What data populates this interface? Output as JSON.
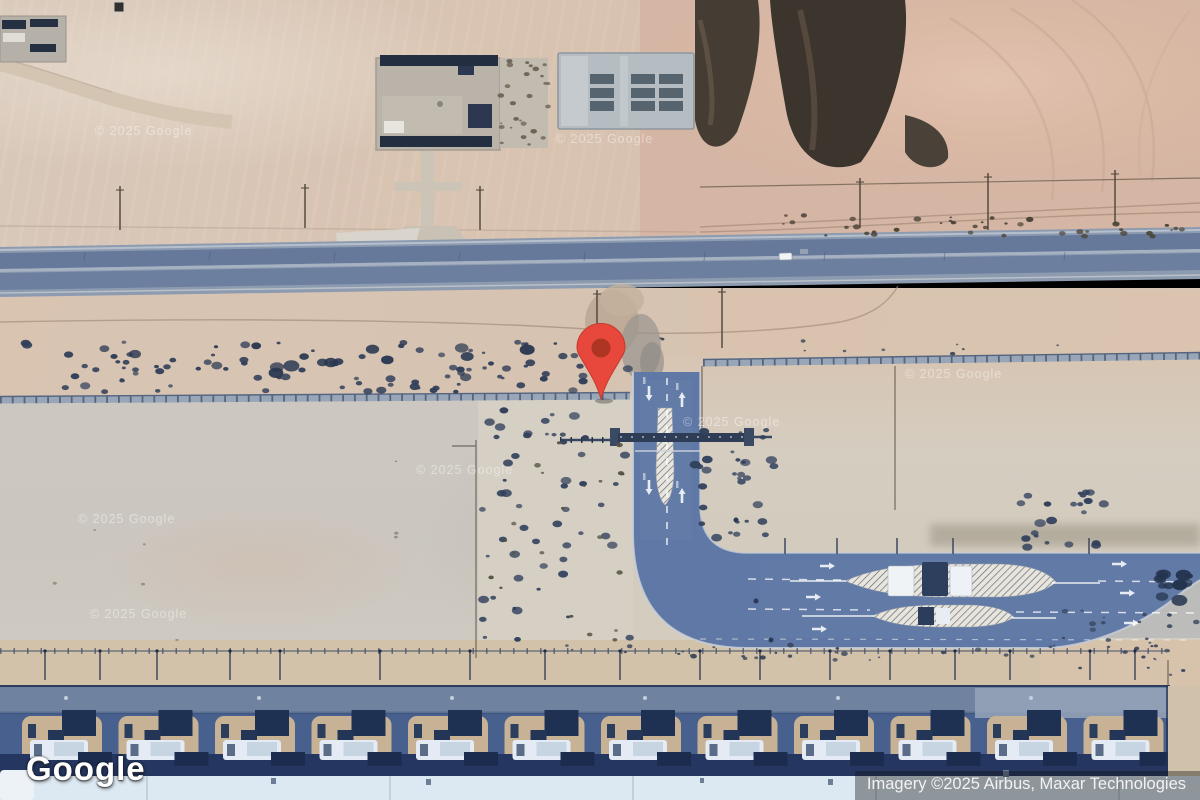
{
  "branding": {
    "logo_text": "Google"
  },
  "attribution": {
    "text": "Imagery ©2025 Airbus, Maxar Technologies"
  },
  "watermark": {
    "text": "© 2025 Google",
    "positions": [
      {
        "x": 95,
        "y": 124
      },
      {
        "x": 556,
        "y": 132
      },
      {
        "x": 905,
        "y": 367
      },
      {
        "x": 683,
        "y": 415
      },
      {
        "x": 416,
        "y": 463
      },
      {
        "x": 78,
        "y": 512
      },
      {
        "x": 90,
        "y": 607
      }
    ]
  },
  "marker": {
    "x": 601,
    "tip_y": 401,
    "color": "#E8473B",
    "inner_color": "#AE3524",
    "stroke": "#C53B2C"
  },
  "palette": {
    "highway": "#8d9bb0",
    "highway_lane": "#66799b",
    "road_blue": "#5f78a5",
    "road_dark_band": "#47608d",
    "bay_tan": "#c7b295",
    "canopy_dark": "#1f3152",
    "truck_white": "#e4ebf4",
    "bottom_strip": "#dce8f2",
    "wall": "#98a6b8",
    "shrub": "#32405a",
    "veg_dark": "#3f382f",
    "pad_gray": "#cbc7c0"
  },
  "features": {
    "truck_bays": {
      "count": 12,
      "start_x": 16,
      "spacing": 96.5
    },
    "light_poles_bottom": [
      45,
      100,
      157,
      230,
      280,
      380,
      470,
      545,
      620,
      700,
      760,
      830,
      890,
      955,
      1010,
      1090,
      1135
    ],
    "tall_poles": [
      {
        "x": 120,
        "y1": 186,
        "y2": 230
      },
      {
        "x": 305,
        "y1": 184,
        "y2": 228
      },
      {
        "x": 480,
        "y1": 186,
        "y2": 230
      },
      {
        "x": 860,
        "y1": 178,
        "y2": 228
      },
      {
        "x": 988,
        "y1": 173,
        "y2": 230
      },
      {
        "x": 1115,
        "y1": 170,
        "y2": 224
      },
      {
        "x": 597,
        "y1": 290,
        "y2": 352
      },
      {
        "x": 722,
        "y1": 288,
        "y2": 348
      }
    ],
    "mid_ticks": [
      785,
      837,
      897,
      953,
      1089
    ],
    "highway_ticks": [
      85,
      210,
      335,
      460,
      585,
      705,
      825,
      945,
      1065
    ],
    "shrub_clusters": [
      {
        "x0": 20,
        "x1": 628,
        "y0": 342,
        "y1": 392,
        "n": 95,
        "rmin": 1.5,
        "rmax": 4.5,
        "seed": 7,
        "color": "#32405a"
      },
      {
        "x0": 30,
        "x1": 618,
        "y0": 345,
        "y1": 378,
        "n": 16,
        "rmin": 4,
        "rmax": 7,
        "seed": 11,
        "color": "#27364f"
      },
      {
        "x0": 640,
        "x1": 1200,
        "y0": 338,
        "y1": 356,
        "n": 10,
        "rmin": 1,
        "rmax": 3,
        "seed": 13,
        "color": "#3a4656"
      },
      {
        "x0": 480,
        "x1": 630,
        "y0": 406,
        "y1": 658,
        "n": 55,
        "rmin": 1.5,
        "rmax": 5,
        "seed": 17,
        "color": "#31405c"
      },
      {
        "x0": 485,
        "x1": 628,
        "y0": 420,
        "y1": 640,
        "n": 20,
        "rmin": 1,
        "rmax": 3,
        "seed": 18,
        "color": "#55523f"
      },
      {
        "x0": 695,
        "x1": 775,
        "y0": 430,
        "y1": 542,
        "n": 30,
        "rmin": 1.5,
        "rmax": 5,
        "seed": 19,
        "color": "#32415c"
      },
      {
        "x0": 1020,
        "x1": 1105,
        "y0": 492,
        "y1": 548,
        "n": 22,
        "rmin": 1.5,
        "rmax": 5,
        "seed": 23,
        "color": "#31405c"
      },
      {
        "x0": 1150,
        "x1": 1198,
        "y0": 573,
        "y1": 610,
        "n": 14,
        "rmin": 3,
        "rmax": 7,
        "seed": 29,
        "color": "#24344e"
      },
      {
        "x0": 780,
        "x1": 1200,
        "y0": 215,
        "y1": 237,
        "n": 40,
        "rmin": 1,
        "rmax": 3.5,
        "seed": 31,
        "color": "#4e463a"
      },
      {
        "x0": 560,
        "x1": 1160,
        "y0": 645,
        "y1": 660,
        "n": 30,
        "rmin": 1,
        "rmax": 3,
        "seed": 37,
        "color": "#3c465c"
      },
      {
        "x0": 30,
        "x1": 460,
        "y0": 420,
        "y1": 650,
        "n": 8,
        "rmin": 1,
        "rmax": 2,
        "seed": 41,
        "color": "#8a8578"
      },
      {
        "x0": 498,
        "x1": 548,
        "y0": 60,
        "y1": 145,
        "n": 26,
        "rmin": 1,
        "rmax": 3,
        "seed": 43,
        "color": "#6b6354"
      },
      {
        "x0": 1050,
        "x1": 1200,
        "y0": 608,
        "y1": 675,
        "n": 26,
        "rmin": 1,
        "rmax": 3,
        "seed": 47,
        "color": "#39465e"
      }
    ],
    "arrows": [
      {
        "x": 649,
        "y": 386,
        "dir": "down"
      },
      {
        "x": 682,
        "y": 392,
        "dir": "up"
      },
      {
        "x": 649,
        "y": 480,
        "dir": "down"
      },
      {
        "x": 682,
        "y": 488,
        "dir": "up"
      },
      {
        "x": 820,
        "y": 566,
        "dir": "right"
      },
      {
        "x": 1112,
        "y": 564,
        "dir": "right"
      },
      {
        "x": 806,
        "y": 597,
        "dir": "right"
      },
      {
        "x": 1120,
        "y": 593,
        "dir": "right"
      },
      {
        "x": 812,
        "y": 629,
        "dir": "right"
      },
      {
        "x": 1124,
        "y": 623,
        "dir": "right"
      },
      {
        "x": 1085,
        "y": 693,
        "dir": "left"
      },
      {
        "x": 1175,
        "y": 691,
        "dir": "left"
      },
      {
        "x": 1040,
        "y": 714,
        "dir": "left"
      },
      {
        "x": 1162,
        "y": 712,
        "dir": "left"
      }
    ],
    "dashed_lines": [
      {
        "x1": 667,
        "y1": 378,
        "x2": 667,
        "y2": 545,
        "w": 1.6,
        "da": "7 9",
        "op": 0.8
      },
      {
        "x1": 748,
        "y1": 579,
        "x2": 844,
        "y2": 580,
        "w": 1.5,
        "da": "8 9",
        "op": 0.75
      },
      {
        "x1": 1098,
        "y1": 581,
        "x2": 1200,
        "y2": 582,
        "w": 1.5,
        "da": "8 9",
        "op": 0.75
      },
      {
        "x1": 748,
        "y1": 609,
        "x2": 870,
        "y2": 610,
        "w": 1.5,
        "da": "8 9",
        "op": 0.75
      },
      {
        "x1": 1016,
        "y1": 612,
        "x2": 1200,
        "y2": 613,
        "w": 1.5,
        "da": "8 9",
        "op": 0.75
      },
      {
        "x1": 700,
        "y1": 639,
        "x2": 1195,
        "y2": 640,
        "w": 1.2,
        "da": "6 10",
        "op": 0.5
      },
      {
        "x1": 988,
        "y1": 700,
        "x2": 1190,
        "y2": 700,
        "w": 1.2,
        "da": "6 8",
        "op": 0.7
      }
    ],
    "solid_guides": [
      {
        "x1": 790,
        "y1": 581,
        "x2": 846,
        "y2": 581
      },
      {
        "x1": 1052,
        "y1": 583,
        "x2": 1100,
        "y2": 583
      },
      {
        "x1": 802,
        "y1": 616,
        "x2": 874,
        "y2": 616
      },
      {
        "x1": 1012,
        "y1": 618,
        "x2": 1056,
        "y2": 618
      }
    ],
    "road_dots": [
      {
        "x": 756,
        "y": 601
      },
      {
        "x": 771,
        "y": 640
      },
      {
        "x": 736,
        "y": 520
      }
    ],
    "label_smudges": [
      {
        "x": 643,
        "y": 377
      },
      {
        "x": 676,
        "y": 383
      },
      {
        "x": 643,
        "y": 473
      },
      {
        "x": 676,
        "y": 481
      }
    ]
  }
}
